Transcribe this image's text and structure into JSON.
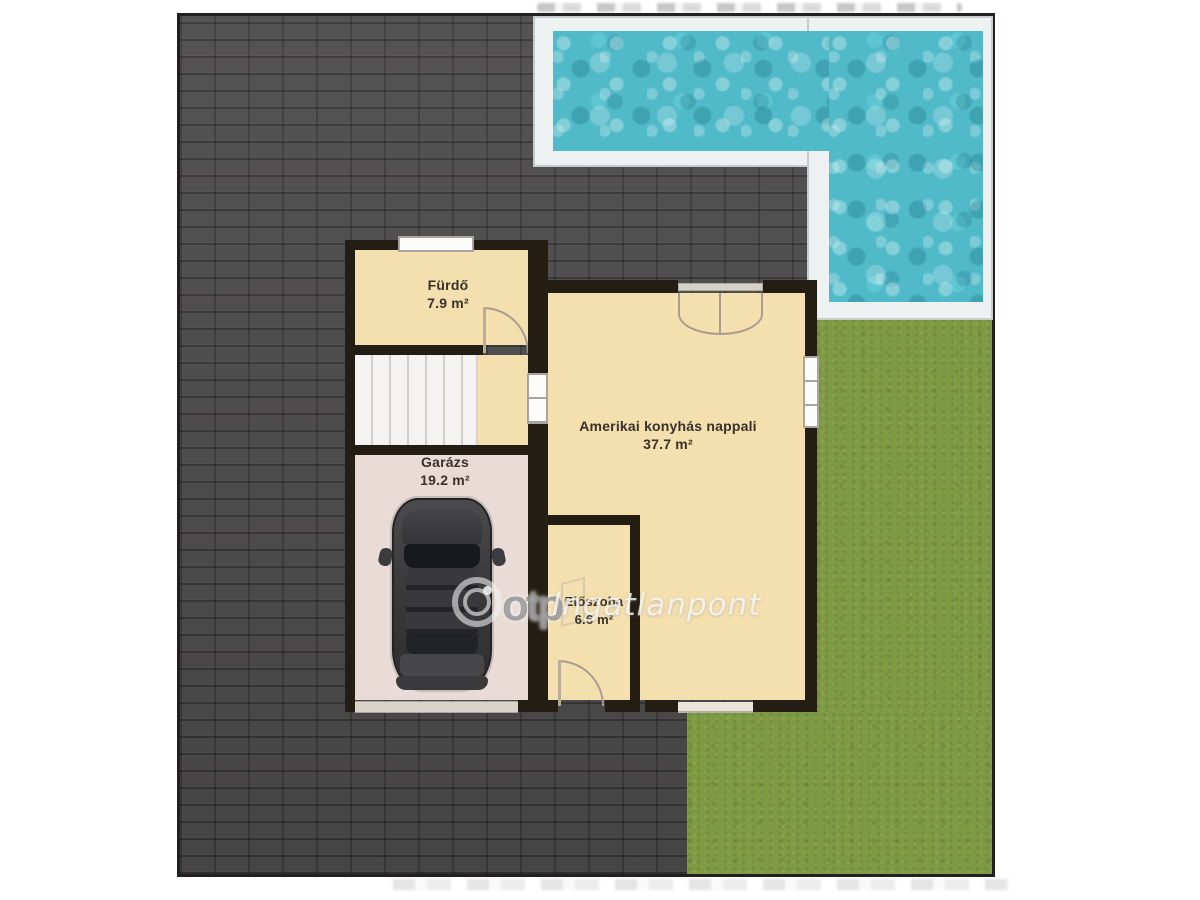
{
  "image_type": "real-estate floor plan (ground floor with garden, terrace and pool)",
  "rooms": [
    {
      "name": "Fürdő",
      "area": "7.9 m²"
    },
    {
      "name": "Garázs",
      "area": "19.2 m²"
    },
    {
      "name": "Amerikai konyhás nappali",
      "area": "37.7 m²"
    },
    {
      "name": "Előszoba",
      "area": "6.6 m²"
    }
  ],
  "watermark": {
    "logo": "otp-circle-logo",
    "otp_text": "otp",
    "brand_text": "Ingatlanpont"
  },
  "features": {
    "pool": "swimming-pool (L-shaped, top right)",
    "lawn": "grass lawn (right and bottom right)",
    "paving": "dark brick terrace / driveway",
    "car": "car top view in garage",
    "stairs": "staircase next to bathroom"
  },
  "colors": {
    "brick": "#4b4a4a",
    "lawn": "#7e9a42",
    "water": "#50bac8",
    "room_floor": "#f4dfaf",
    "garage_floor": "#e9dcd6",
    "wall": "#241d14",
    "pool_frame": "#eef1f1",
    "background": "#ffffff"
  }
}
